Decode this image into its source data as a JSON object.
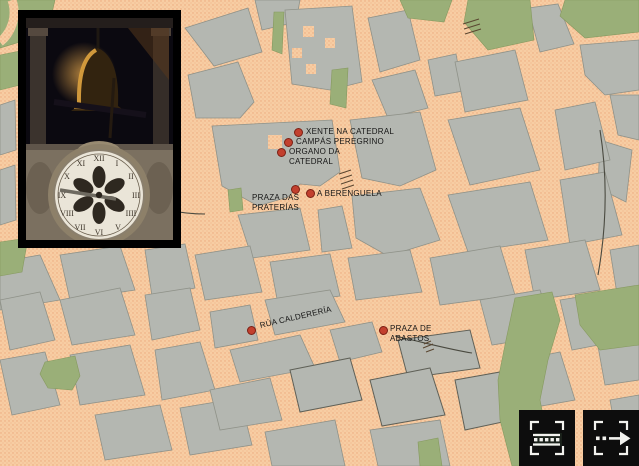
{
  "colors": {
    "street": "#f7cda3",
    "block": "#b4b7b1",
    "block_outline": "#8f9289",
    "park": "#9aaf78",
    "marker_fill": "#c2402e",
    "marker_ring": "#7c2014",
    "label_text": "#161616",
    "button_bg": "#0d0d0d",
    "button_icon": "#f2f2ee",
    "photo_frame": "#000000"
  },
  "map": {
    "markers": [
      {
        "id": "xente-na-catedral",
        "label_lines": [
          "XENTE NA CATEDRAL"
        ],
        "dot": {
          "x": 298,
          "y": 132
        },
        "label": {
          "x": 306,
          "y": 127
        }
      },
      {
        "id": "campas-peregrino",
        "label_lines": [
          "CAMPÁS PEREGRINO"
        ],
        "dot": {
          "x": 288,
          "y": 142
        },
        "label": {
          "x": 296,
          "y": 137
        }
      },
      {
        "id": "organo-da-catedral",
        "label_lines": [
          "ORGANO DA",
          "CATEDRAL"
        ],
        "dot": {
          "x": 281,
          "y": 152
        },
        "label": {
          "x": 289,
          "y": 147
        }
      },
      {
        "id": "praza-das-praterias",
        "label_lines": [
          "PRAZA DAS",
          "PRATERÍAS"
        ],
        "dot": {
          "x": 295,
          "y": 189
        },
        "label": {
          "x": 252,
          "y": 193
        }
      },
      {
        "id": "a-berenguela",
        "label_lines": [
          "A BERENGUELA"
        ],
        "dot": {
          "x": 310,
          "y": 193
        },
        "label": {
          "x": 317,
          "y": 189
        }
      },
      {
        "id": "rua-caldereria",
        "label_lines": [
          "RÚA CALDERERÍA"
        ],
        "dot": {
          "x": 251,
          "y": 330
        },
        "label": {
          "x": 260,
          "y": 321
        },
        "rotation": -13
      },
      {
        "id": "praza-de-abastos",
        "label_lines": [
          "PRAZA DE",
          "ABASTOS"
        ],
        "dot": {
          "x": 383,
          "y": 330
        },
        "label": {
          "x": 390,
          "y": 324
        }
      }
    ]
  },
  "toolbar": {
    "buttons": [
      {
        "id": "filmstrip",
        "icon": "bracket-dashed-bar-icon"
      },
      {
        "id": "forward",
        "icon": "bracket-dashed-arrow-icon"
      }
    ]
  },
  "photo_inset": {
    "subject_icons": [
      "bell-photo-icon",
      "clock-face-photo-icon"
    ]
  }
}
